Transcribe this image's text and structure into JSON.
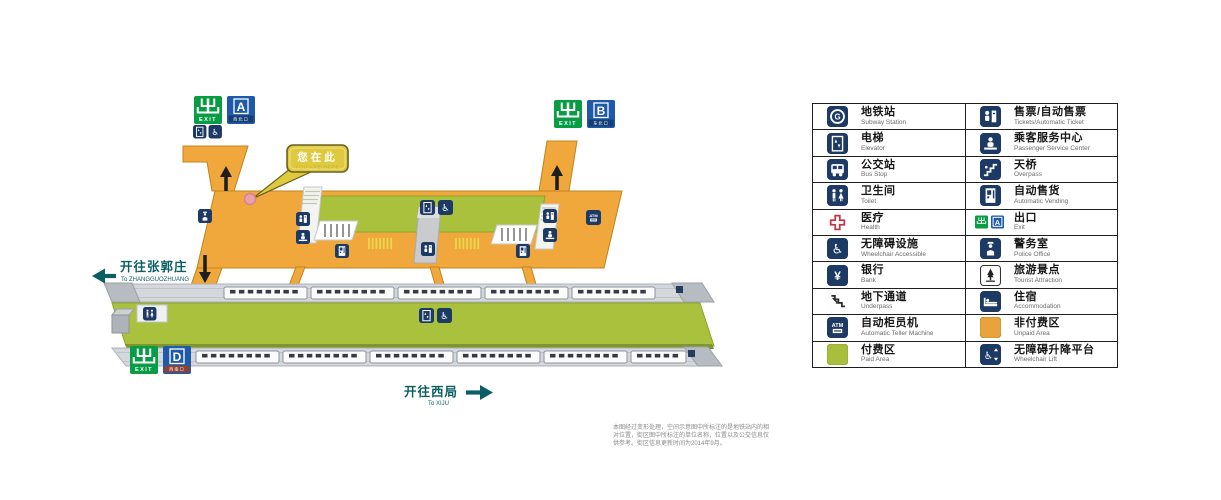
{
  "map": {
    "you_are_here": {
      "zh": "您在此",
      "en": "YOU ARE HERE"
    },
    "exits": {
      "exit_en": "EXIT",
      "a": {
        "letter": "A",
        "sub": "西北口"
      },
      "b": {
        "letter": "B",
        "sub": "东北口"
      },
      "d": {
        "letter": "D",
        "sub": "西南口"
      }
    },
    "directions": {
      "left": {
        "zh": "开往张郭庄",
        "en": "To ZHANGGUOZHUANG"
      },
      "bottom": {
        "zh": "开往西局",
        "en": "To XIJU"
      }
    }
  },
  "icons": {
    "atm_text": "ATM",
    "subway_letter": "G",
    "yen": "¥"
  },
  "legend": {
    "rows": [
      {
        "left": {
          "zh": "地铁站",
          "en": "Subway Station"
        },
        "right": {
          "zh": "售票/自动售票",
          "en": "Tickets/Automatic Ticket"
        }
      },
      {
        "left": {
          "zh": "电梯",
          "en": "Elevator"
        },
        "right": {
          "zh": "乘客服务中心",
          "en": "Passenger Service Center"
        }
      },
      {
        "left": {
          "zh": "公交站",
          "en": "Bus Stop"
        },
        "right": {
          "zh": "天桥",
          "en": "Overpass"
        }
      },
      {
        "left": {
          "zh": "卫生间",
          "en": "Toilet"
        },
        "right": {
          "zh": "自动售货",
          "en": "Automatic Vending"
        }
      },
      {
        "left": {
          "zh": "医疗",
          "en": "Health"
        },
        "right": {
          "zh": "出口",
          "en": "Exit"
        }
      },
      {
        "left": {
          "zh": "无障碍设施",
          "en": "Wheelchair Accessible"
        },
        "right": {
          "zh": "警务室",
          "en": "Police Office"
        }
      },
      {
        "left": {
          "zh": "银行",
          "en": "Bank"
        },
        "right": {
          "zh": "旅游景点",
          "en": "Tourist Attraction"
        }
      },
      {
        "left": {
          "zh": "地下通道",
          "en": "Underpass"
        },
        "right": {
          "zh": "住宿",
          "en": "Accommodation"
        }
      },
      {
        "left": {
          "zh": "自动柜员机",
          "en": "Automatic Teller Machine"
        },
        "right": {
          "zh": "非付费区",
          "en": "Unpaid Area"
        }
      },
      {
        "left": {
          "zh": "付费区",
          "en": "Paid Area"
        },
        "right": {
          "zh": "无障碍升降平台",
          "en": "Wheelchair Lift"
        }
      }
    ]
  },
  "note": {
    "lines": [
      "本图经过变形处理，空间示意图中所标注的是地铁站内的相",
      "对位置，街区图中所标注的单位名称，位置以及公交信息仅",
      "供参考。街区信息更新时间为2014年9月。"
    ]
  },
  "colors": {
    "unpaid_area": "#F0A73C",
    "paid_area": "#A9C13C",
    "icon_navy": "#1C3A64",
    "exit_green": "#089C44",
    "sign_blue": "#1E5AA9",
    "direction_teal": "#0B5E63",
    "callout_yellow": "#DFC93F",
    "here_dot_pink": "#EC9EAB"
  }
}
